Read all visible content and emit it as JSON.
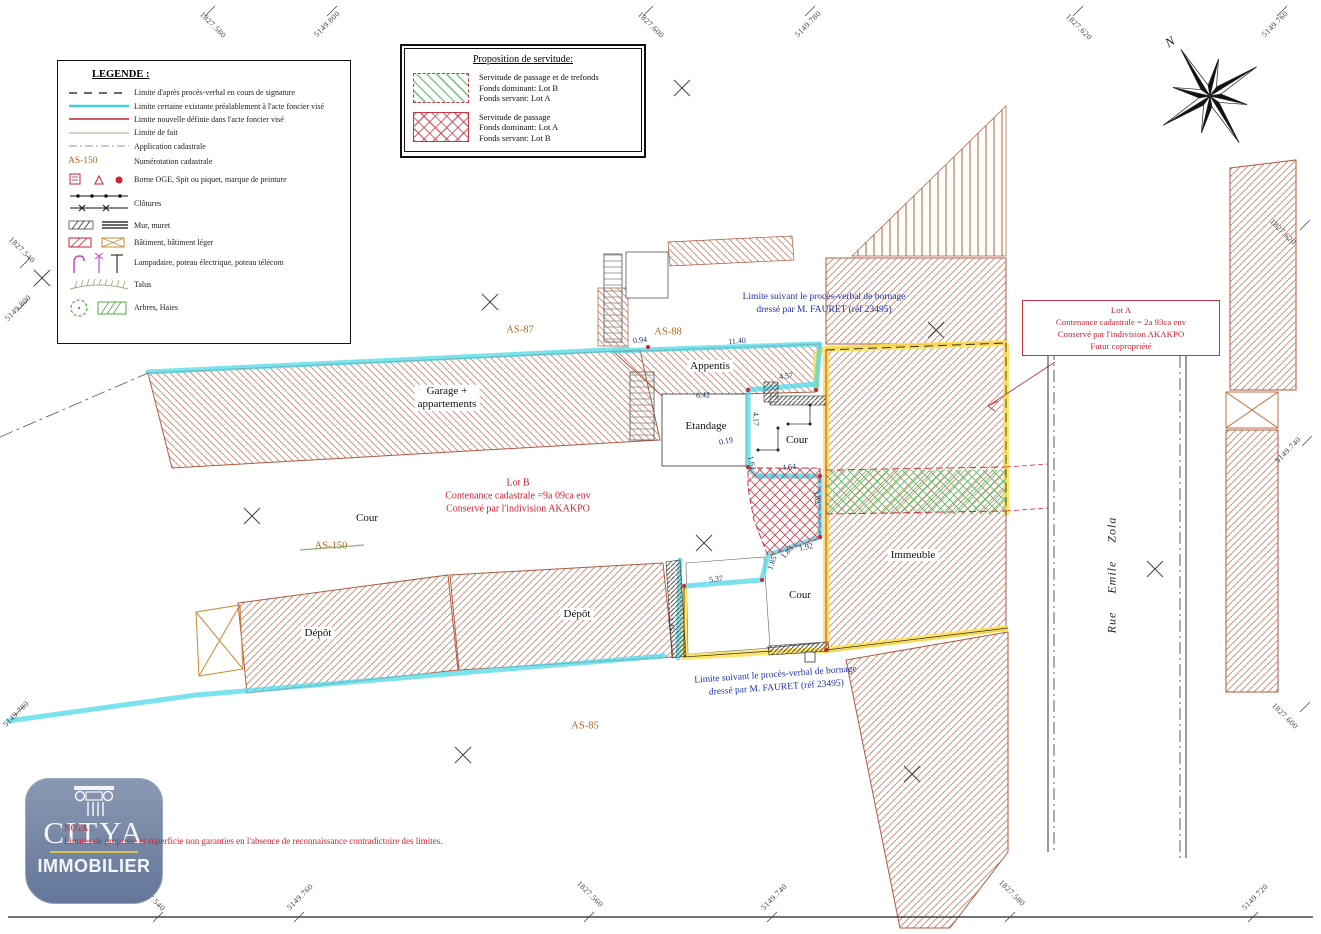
{
  "legend": {
    "title": "LEGENDE :",
    "sample_parcel": "AS-150",
    "items": [
      "Limite d'après procès-verbal en cours de signature",
      "Limite certaine existante préalablement à l'acte foncier visé",
      "Limite nouvelle définie dans l'acte foncier visé",
      "Limite de fait",
      "Application cadastrale",
      "Numérotation cadastrale",
      "Borne OGE, Spit ou piquet, marque de peinture",
      "Clôtures",
      "Mur, muret",
      "Bâtiment, bâtiment léger",
      "Lampadaire, poteau électrique, poteau télécom",
      "Talus",
      "Arbres, Haies"
    ]
  },
  "servitude": {
    "title": "Proposition de servitude:",
    "items": [
      {
        "l1": "Servitude de passage et de trefonds",
        "l2": "Fonds dominant: Lot B",
        "l3": "Fonds servant: Lot A"
      },
      {
        "l1": "Servitude de passage",
        "l2": "Fonds dominant: Lot A",
        "l3": "Fonds servant: Lot B"
      }
    ]
  },
  "compass": {
    "north": "N"
  },
  "lot_a": {
    "l1": "Lot A",
    "l2": "Contenance cadastrale = 2a 93ca env",
    "l3": "Conservé par l'indivision AKAKPO",
    "l4": "Futur copropriété"
  },
  "lot_b": {
    "l1": "Lot B",
    "l2": "Contenance cadastrale =9a 09ca env",
    "l3": "Conservé par l'indivision AKAKPO"
  },
  "bornage_note": {
    "l1": "Limite suivant le procès-verbal de bornage",
    "l2": "dressé par M. FAURET (réf 23495)"
  },
  "parcels": {
    "as87": "AS-87",
    "as88": "AS-88",
    "as150": "AS-150",
    "as85": "AS-85"
  },
  "buildings": {
    "garage_l1": "Garage +",
    "garage_l2": "appartements",
    "appentis": "Appentis",
    "etandage": "Etandage",
    "cour": "Cour",
    "depot": "Dépôt",
    "immeuble": "Immeuble"
  },
  "street": {
    "name": "Rue  Emile  Zola"
  },
  "measurements": [
    "0.94",
    "11.40",
    "4.57",
    "6.42",
    "4.17",
    "0.19",
    "4.64",
    "1.62",
    "3.82",
    "1.92",
    "1.83",
    "1.85",
    "5.37",
    "4.45"
  ],
  "grid_labels": [
    "1827.580",
    "5149.800",
    "1827.600",
    "5149.780",
    "1827.620",
    "5149.760",
    "1827.540",
    "5149.800",
    "5149.780",
    "1827.540",
    "5149.760",
    "1827.560",
    "5149.740",
    "1827.580",
    "5149.720",
    "1827.620",
    "5149.740",
    "1827.600"
  ],
  "nota": {
    "l1": "NOTA :",
    "l2": "Limites de propriété et superficie non garanties en l'absence de reconnaissance contradictoire des limites."
  },
  "logo": {
    "brand": "CITYA",
    "subtitle": "IMMOBILIER"
  }
}
